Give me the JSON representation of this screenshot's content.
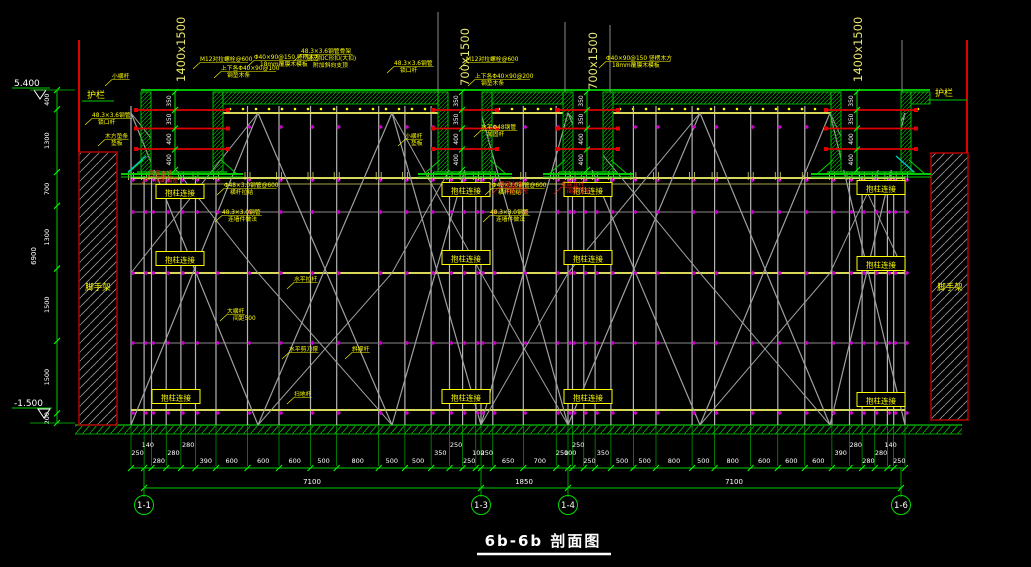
{
  "drawing": {
    "title": "6b-6b 剖面图",
    "elevations": {
      "top": "5.400",
      "bottom": "-1.500"
    },
    "guardrail_label": "护栏",
    "scaffold_wall_label": "脚手架",
    "column_tie_label": "抱柱连接",
    "beam_labels": [
      "1400x1500",
      "700x1500",
      "700x1500",
      "1400x1500"
    ],
    "beam_dim_values": [
      "350",
      "350",
      "400",
      "400"
    ],
    "left_dims": {
      "segments": [
        "400",
        "1300",
        "700",
        "1300",
        "1500",
        "1500",
        "200"
      ],
      "total": "6900"
    },
    "bottom_dims": {
      "groups": [
        {
          "segments": [
            250,
            140,
            280,
            280,
            280,
            390,
            600,
            600,
            600,
            500,
            800,
            500,
            500,
            350,
            250,
            250,
            100
          ],
          "total": "7100"
        },
        {
          "segments": [
            250,
            650,
            700,
            250
          ],
          "total": "1850"
        },
        {
          "segments": [
            100,
            250,
            250,
            350,
            500,
            500,
            800,
            500,
            800,
            600,
            600,
            600,
            390,
            280,
            280,
            280,
            140,
            250
          ],
          "total": "7100"
        }
      ]
    },
    "axis_bubbles": [
      "1-1",
      "1-3",
      "1-4",
      "1-6"
    ],
    "annotations": [
      {
        "lines": [
          "小横杆"
        ],
        "color": "yellow"
      },
      {
        "lines": [
          "M12对拉螺栓@600"
        ],
        "color": "yellow"
      },
      {
        "lines": [
          "上下各Φ40×90@100",
          "钢垫木条"
        ],
        "color": "yellow"
      },
      {
        "lines": [
          "Φ40×90@150 竖楞木方",
          "18mm覆膜木模板"
        ],
        "color": "yellow"
      },
      {
        "lines": [
          "48.3×3.6钢管骨架",
          "骑马扣C形扣(大扣)",
          "附加斜向支顶"
        ],
        "color": "yellow"
      },
      {
        "lines": [
          "48.3×3.6钢管",
          "锁口杆"
        ],
        "color": "yellow"
      },
      {
        "lines": [
          "木方垫条",
          "垫板"
        ],
        "color": "yellow"
      },
      {
        "lines": [
          "48.3×3.6钢管",
          "锁口杆"
        ],
        "color": "yellow"
      },
      {
        "lines": [
          "M12对拉螺栓@600"
        ],
        "color": "yellow"
      },
      {
        "lines": [
          "上下各Φ40×90@200",
          "钢垫木条"
        ],
        "color": "yellow"
      },
      {
        "lines": [
          "水平Φ48钢管",
          "加固杆"
        ],
        "color": "yellow"
      },
      {
        "lines": [
          "小横杆",
          "垫板"
        ],
        "color": "yellow"
      },
      {
        "lines": [
          "Φ40×90@150 竖楞木方",
          "18mm覆膜木模板"
        ],
        "color": "yellow"
      },
      {
        "lines": [
          "Φ48×3.0钢管@600",
          "横杆拉结"
        ],
        "color": "yellow"
      },
      {
        "lines": [
          "48.3×3.0钢管",
          "连墙件做法"
        ],
        "color": "yellow"
      },
      {
        "lines": [
          "Φ48×3.0钢管@600",
          "横杆拉结"
        ],
        "color": "yellow"
      },
      {
        "lines": [
          "48.3×3.0钢管",
          "连墙件做法"
        ],
        "color": "yellow"
      },
      {
        "lines": [
          "水平拉杆"
        ],
        "color": "yellow"
      },
      {
        "lines": [
          "大横杆",
          "间距500"
        ],
        "color": "yellow"
      },
      {
        "lines": [
          "水平剪刀撑"
        ],
        "color": "yellow"
      },
      {
        "lines": [
          "斜撑杆"
        ],
        "color": "yellow"
      },
      {
        "lines": [
          "扫地杆"
        ],
        "color": "yellow"
      },
      {
        "lines": [
          "梁底立杆",
          "间距加密"
        ],
        "color": "red"
      },
      {
        "lines": [
          "梁底立杆",
          "间距加密"
        ],
        "color": "red"
      },
      {
        "lines": [
          "梁底立杆",
          "间距加密"
        ],
        "color": "red"
      }
    ],
    "colors": {
      "background": "#000000",
      "dim_green": "#00c800",
      "bright_green": "#00ff00",
      "yellow": "#ffff00",
      "runner_yellow": "#d8d85c",
      "red": "#e00000",
      "dark_red": "#aa0000",
      "magenta": "#cc00cc",
      "post_gray": "#b5b5b5",
      "brace_gray": "#a0a0a0",
      "white": "#ffffff",
      "cyan": "#00cccc"
    }
  }
}
